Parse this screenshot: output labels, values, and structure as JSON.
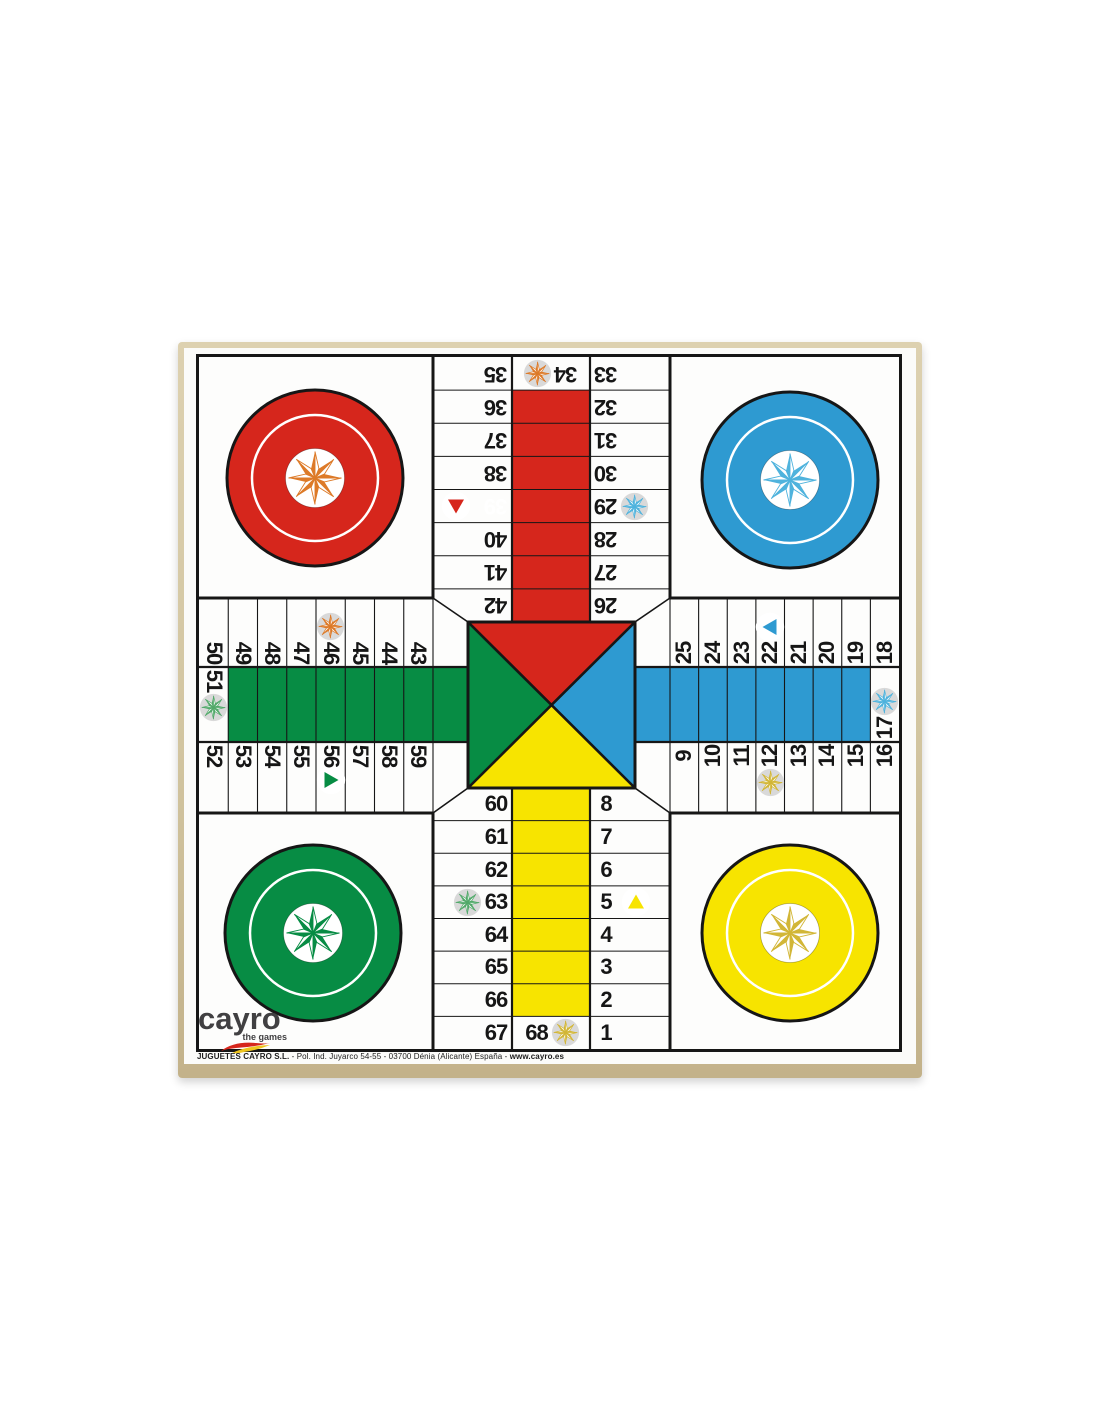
{
  "brand": {
    "logo": "cayro",
    "tagline": "the games",
    "footer_company": "JUGUETES CAYRO S.L.",
    "footer_address": " - Pol. Ind. Juyarco 54-55 - 03700 Dénia (Alicante) España - ",
    "footer_web": "www.cayro.es"
  },
  "colors": {
    "red": "#d6261c",
    "blue": "#2e9ad1",
    "green": "#078c44",
    "yellow": "#f7e400",
    "orange": "#dd7a28",
    "star_blue": "#4fb3dd",
    "star_green": "#52a96a",
    "gold": "#d2b636",
    "star_disc": "#d9d9d9",
    "ink": "#161616",
    "wood": "#d2c5a0",
    "logo_ink": "#414042",
    "badge_bg": "#ffffff"
  },
  "board": {
    "top_arm": {
      "left_column": [
        35,
        36,
        37,
        38,
        39,
        40,
        41,
        42
      ],
      "center_top": 34,
      "right_column": [
        33,
        32,
        31,
        30,
        29,
        28,
        27,
        26
      ],
      "path_color": "red"
    },
    "right_arm": {
      "top_row": [
        25,
        24,
        23,
        22,
        21,
        20,
        19,
        18
      ],
      "center_right": 17,
      "bottom_row": [
        9,
        10,
        11,
        12,
        13,
        14,
        15,
        16
      ],
      "path_color": "blue"
    },
    "bottom_arm": {
      "left_column": [
        60,
        61,
        62,
        63,
        64,
        65,
        66,
        67
      ],
      "center_bottom": 68,
      "right_column": [
        8,
        7,
        6,
        5,
        4,
        3,
        2,
        1
      ],
      "path_color": "yellow"
    },
    "left_arm": {
      "top_row": [
        50,
        49,
        48,
        47,
        46,
        45,
        44,
        43
      ],
      "center_left": 51,
      "bottom_row": [
        52,
        53,
        54,
        55,
        56,
        57,
        58,
        59
      ],
      "path_color": "green"
    },
    "center": {
      "top": "red",
      "right": "blue",
      "bottom": "yellow",
      "left": "green"
    },
    "safe_cells": [
      {
        "cell": 34,
        "star": "orange",
        "position": "before"
      },
      {
        "cell": 29,
        "star": "star_blue",
        "position": "after"
      },
      {
        "cell": 46,
        "star": "orange",
        "position": "before"
      },
      {
        "cell": 51,
        "star": "star_green",
        "position": "after"
      },
      {
        "cell": 17,
        "star": "star_blue",
        "position": "before"
      },
      {
        "cell": 12,
        "star": "gold",
        "position": "after"
      },
      {
        "cell": 63,
        "star": "star_green",
        "position": "before"
      },
      {
        "cell": 68,
        "star": "gold",
        "position": "after"
      }
    ],
    "exit_cells": [
      {
        "cell": 39,
        "color": "red",
        "direction": "down",
        "number_color": "#ffffff"
      },
      {
        "cell": 22,
        "color": "blue",
        "direction": "left",
        "number_color": "#161616"
      },
      {
        "cell": 56,
        "color": "green",
        "direction": "right",
        "number_color": "#161616"
      },
      {
        "cell": 5,
        "color": "yellow",
        "direction": "up",
        "number_color": "#161616"
      }
    ],
    "home_circles": [
      {
        "corner": "top-left",
        "color": "red",
        "star": "orange"
      },
      {
        "corner": "top-right",
        "color": "blue",
        "star": "star_blue"
      },
      {
        "corner": "bottom-left",
        "color": "green",
        "star": "green"
      },
      {
        "corner": "bottom-right",
        "color": "yellow",
        "star": "gold"
      }
    ]
  }
}
